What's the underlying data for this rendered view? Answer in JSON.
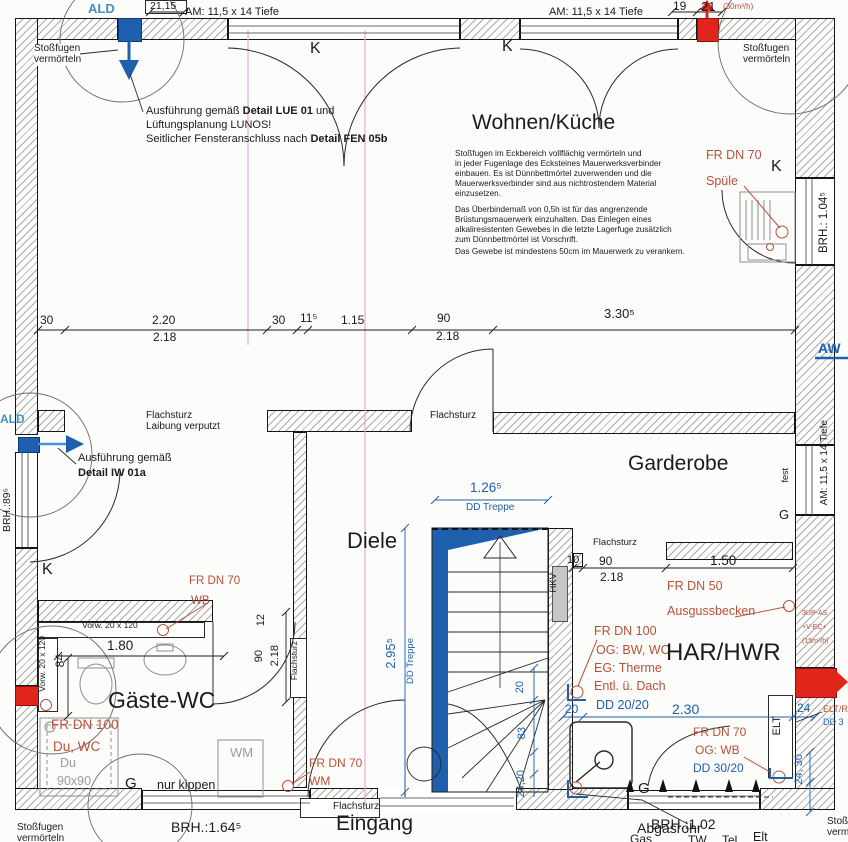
{
  "colors": {
    "ink": "#1b1b1b",
    "blue": "#1e5fae",
    "light_blue": "#3f8fcc",
    "red_text": "#b9503a",
    "red_fill": "#e0251b",
    "magenta": "#eaaad8",
    "hatch": "#ababab",
    "paper": "#fcfcfa",
    "gray": "#9b9b9b"
  },
  "rooms": {
    "wohnen": "Wohnen/Küche",
    "diele": "Diele",
    "garderobe": "Garderobe",
    "gaeste_wc": "Gäste-WC",
    "har": "HAR/HWR",
    "eingang": "Eingang"
  },
  "notes": {
    "stossfugen": "Stoßfugen",
    "vermoerteln": "vermörteln",
    "lue_1a": "Ausführung gemäß ",
    "lue_1b": "Detail LUE 01",
    "lue_1c": " und",
    "lue_2": "Lüftungsplanung LUNOS!",
    "lue_3a": "Seitlicher Fensteranschluss nach ",
    "lue_3b": "Detail FEN 05b",
    "iw_1": "Ausführung gemäß",
    "iw_2": "Detail IW 01a",
    "eck_1": "Stoßfugen im Eckbereich vollflächig vermörteln und",
    "eck_2": "in jeder Fugenlage des Ecksteines Mauerwerksverbinder",
    "eck_3": "einbauen. Es ist Dünnbettmörtel zuverwenden und die",
    "eck_4": "Mauerwerksverbinder sind aus nichtrostendem Material",
    "eck_5": "einzusetzen.",
    "ueb_1": "Das Überbindemaß von 0,5h ist für das angrenzende",
    "ueb_2": "Brüstungsmauerwerk einzuhalten. Das Einlegen eines",
    "ueb_3": "alkaliresistenten Gewebes in die letzte Lagerfuge zusätzlich",
    "ueb_4": "zum Dünnbettmörtel ist Vorschrift.",
    "ueb_5": "Das Gewebe ist mindestens 50cm im Mauerwerk zu verankern.",
    "flachsturz": "Flachsturz",
    "laibung": "Laibung verputzt",
    "nur_kippen": "nur kippen",
    "abgasrohr": "Abgasrohr",
    "fest": "fest",
    "vorw": "Vorw. 20 x 120"
  },
  "vents": {
    "ald": "ALD",
    "aw": "AW",
    "flow_30": "(30m³/h)",
    "up_as": "3UP-AS",
    "v_ec": "+V-EC+",
    "flow_15": "(15m³/h)"
  },
  "plumbing": {
    "fr70": "FR DN 70",
    "fr50": "FR DN 50",
    "fr100": "FR DN 100",
    "spuele": "Spüle",
    "wb": "WB",
    "wm": "WM",
    "ausguss": "Ausgussbecken",
    "du_wc": "Du, WC",
    "og_bw": "OG: BW, WC",
    "eg_therme": "EG: Therme",
    "entl": "Entl. ü. Dach",
    "dd2020": "DD 20/20",
    "og_wb": "OG: WB",
    "dd3020": "DD 30/20",
    "elt": "ELT",
    "elt_r": "ELT/R",
    "dd30": "DD 3",
    "du": "Du",
    "du_size": "90x90",
    "hkv": "HKV"
  },
  "dims": {
    "d21_15": "21,15",
    "d19": "19",
    "d21": "21",
    "am_tiefe": "AM: 11,5 x 14 Tiefe",
    "d30a": "30",
    "d220": "2.20",
    "d218a": "2.18",
    "d30b": "30",
    "d115": "11⁵",
    "d1_15": "1.15",
    "d90a": "90",
    "d218b": "2.18",
    "d330": "3.30⁵",
    "brh104": "BRH.: 1.04⁵",
    "brh89": "BRH.:89⁵",
    "brh164": "BRH.:1.64⁵",
    "brh102": "BRH.:1.02",
    "d126": "1.26⁵",
    "dd_treppe": "DD Treppe",
    "d295": "2.95⁵",
    "d10": "10",
    "d90b": "90",
    "d218c": "2.18",
    "d150": "1.50",
    "d12": "12",
    "d90c": "90",
    "d218d": "2.18",
    "d180": "1.80",
    "d84": "84",
    "d20a": "20",
    "d83": "83",
    "d2420": "24,20",
    "d20b": "20",
    "d230": "2.30",
    "d24a": "24",
    "d2430": "24, 30",
    "k": "K",
    "g": "G"
  },
  "bottom": {
    "gas": "Gas",
    "tw": "TW",
    "tel": "Tel.",
    "elt": "Elt"
  }
}
